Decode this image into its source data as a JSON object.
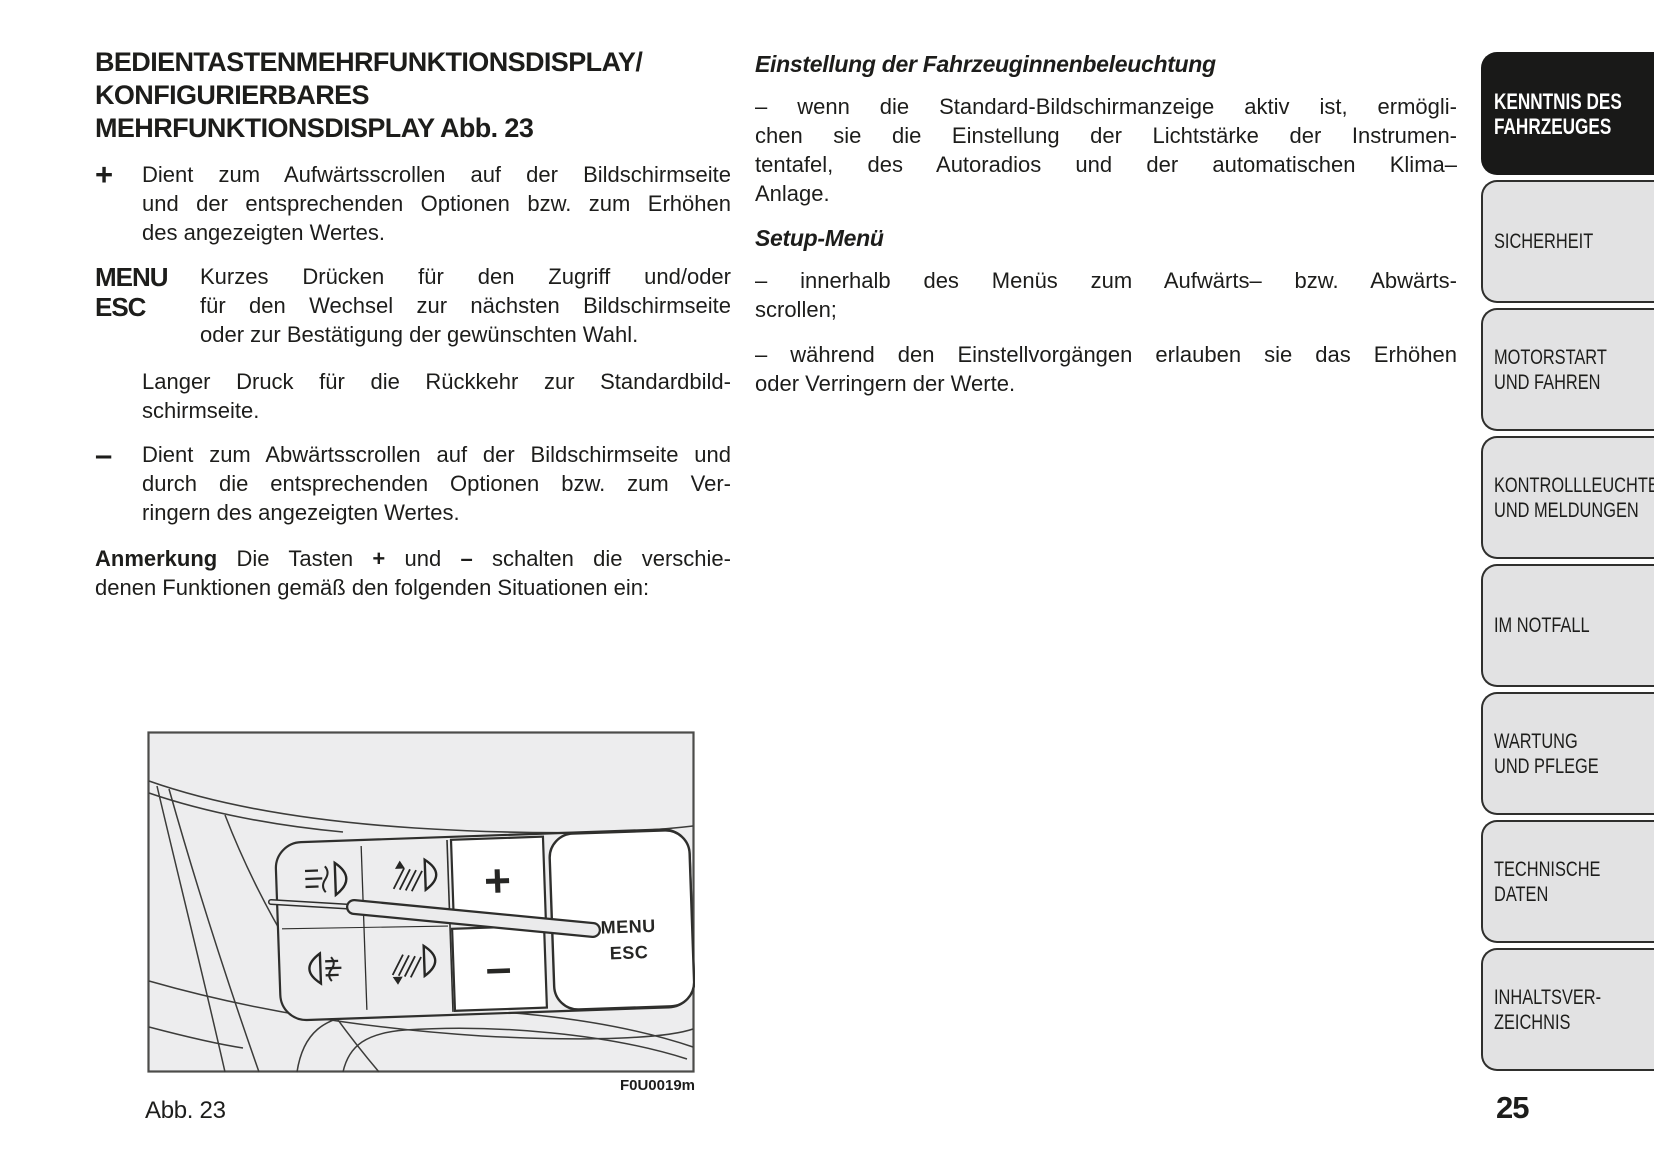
{
  "page": {
    "number": "25"
  },
  "colors": {
    "text": "#1d1d1b",
    "tab_active_bg": "#191918",
    "tab_active_text": "#ffffff",
    "tab_inactive_bg": "#e2e2e3",
    "figure_bg": "#ededee",
    "figure_line": "#2f2f2d"
  },
  "left_column": {
    "heading_lines": [
      "BEDIENTASTENMEHRFUNKTIONSDISPLAY/",
      "KONFIGURIERBARES",
      "MEHRFUNKTIONSDISPLAY Abb. 23"
    ],
    "plus_item": {
      "symbol": "+",
      "lines": [
        "Dient zum Aufwärtsscrollen auf der Bildschirmseite",
        "und der entsprechenden Optionen bzw. zum Erhöhen",
        "des angezeigten Wertes."
      ]
    },
    "menu_item": {
      "symbol_lines": [
        "MENU",
        "ESC"
      ],
      "lines": [
        "Kurzes Drücken für den Zugriff und/oder",
        "für den Wechsel zur nächsten Bildschirmseite",
        "oder zur Bestätigung der gewünschten Wahl."
      ]
    },
    "long_press_para": {
      "lines": [
        "Langer Druck für die Rückkehr zur Standardbild-",
        "schirmseite."
      ]
    },
    "minus_item": {
      "symbol": "–",
      "lines": [
        "Dient zum Abwärtsscrollen auf der Bildschirmseite und",
        "durch die entsprechenden Optionen bzw. zum Ver-",
        "ringern des angezeigten Wertes."
      ]
    },
    "note": {
      "line1_parts": [
        "Anmerkung",
        " Die Tasten ",
        "+",
        " und ",
        "–",
        " schalten die verschie-"
      ],
      "line2": "denen Funktionen gemäß den folgenden Situationen ein:"
    }
  },
  "right_column": {
    "heading1": "Einstellung der Fahrzeuginnenbeleuchtung",
    "para1_lines": [
      "– wenn die Standard-Bildschirmanzeige aktiv ist, ermögli-",
      "chen sie die Einstellung der Lichtstärke der Instrumen-",
      "tentafel, des Autoradios und der automatischen Klima–",
      "Anlage."
    ],
    "heading2": "Setup-Menü",
    "para2_lines": [
      "– innerhalb des Menüs zum Aufwärts– bzw. Abwärts-",
      "scrollen;"
    ],
    "para3_lines": [
      "– während den Einstellvorgängen erlauben sie das Erhöhen",
      "oder Verringern der Werte."
    ]
  },
  "sidebar": {
    "tabs": [
      {
        "lines": [
          "KENNTNIS DES",
          "FAHRZEUGES"
        ],
        "active": true
      },
      {
        "lines": [
          "SICHERHEIT"
        ],
        "active": false
      },
      {
        "lines": [
          "MOTORSTART",
          "UND FAHREN"
        ],
        "active": false
      },
      {
        "lines": [
          "KONTROLLLEUCHTEN",
          "UND MELDUNGEN"
        ],
        "active": false
      },
      {
        "lines": [
          "IM NOTFALL"
        ],
        "active": false
      },
      {
        "lines": [
          "WARTUNG",
          "UND PFLEGE"
        ],
        "active": false
      },
      {
        "lines": [
          "TECHNISCHE",
          "DATEN"
        ],
        "active": false
      },
      {
        "lines": [
          "INHALTSVER-",
          "ZEICHNIS"
        ],
        "active": false
      }
    ]
  },
  "figure": {
    "caption": "Abb. 23",
    "code": "F0U0019m",
    "labels": {
      "plus": "+",
      "minus": "–",
      "menu": "MENU",
      "esc": "ESC"
    },
    "icons": [
      "front-fog-light-icon",
      "headlight-leveling-up-icon",
      "rear-fog-light-icon",
      "headlight-leveling-down-icon"
    ]
  }
}
